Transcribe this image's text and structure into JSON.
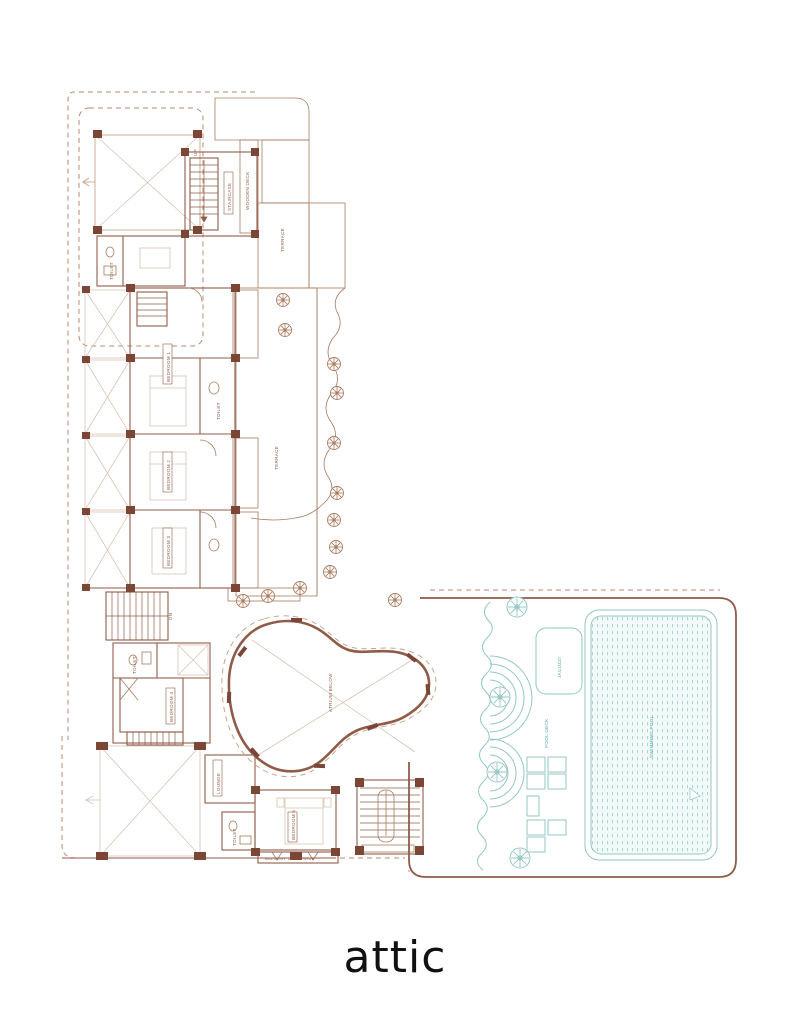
{
  "caption": {
    "text": "attic",
    "color": "#111111"
  },
  "colors": {
    "plan_brown": "#8f5c49",
    "plan_brown_light": "#c49a80",
    "wall_post_fill": "#7b4636",
    "deck_wood": "#c99c7e",
    "stipple_dot": "#c79e83",
    "teal_line": "#93c7c5",
    "teal_text": "#4da5a3",
    "caption_black": "#111111",
    "background": "#ffffff"
  },
  "labels": {
    "staircase": "STAIRCASE",
    "up": "UP",
    "dn": "DN",
    "terrace": "TERRACE",
    "deck": "WOODEN DECK",
    "bedroom1": "BEDROOM 1",
    "bedroom2": "BEDROOM 2",
    "bedroom3": "BEDROOM 3",
    "bedroom4": "BEDROOM 4",
    "bedroom5": "BEDROOM 5",
    "lounge": "LOUNGE",
    "toilet": "TOILET",
    "atrium": "ATRIUM BELOW",
    "balcony": "BALCONY 1.20 M WIDE",
    "pool": "SWIMMING POOL",
    "jacuzzi": "JACUZZI",
    "pooldeck": "POOL DECK"
  }
}
